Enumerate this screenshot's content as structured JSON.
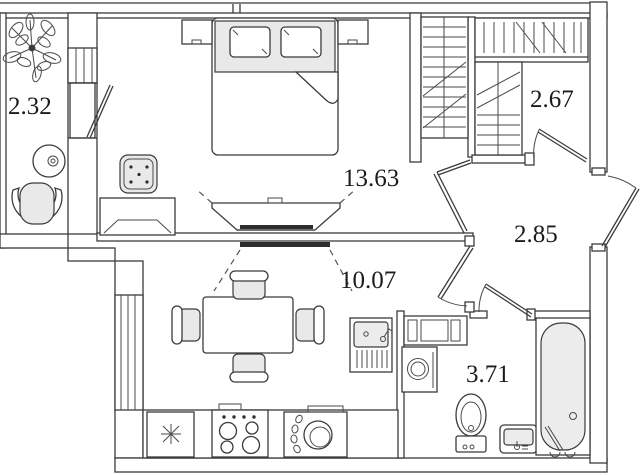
{
  "floor_plan": {
    "type": "apartment-floor-plan",
    "rooms": [
      {
        "name": "balcony",
        "area": "2.32"
      },
      {
        "name": "bedroom",
        "area": "13.63"
      },
      {
        "name": "closet",
        "area": "2.67"
      },
      {
        "name": "hallway",
        "area": "2.85"
      },
      {
        "name": "kitchen-living-room",
        "area": "10.07"
      },
      {
        "name": "bathroom",
        "area": "3.71"
      }
    ],
    "colors": {
      "wall_line": "#3b3b3b",
      "light_fill": "#e9e9e9",
      "background": "#ffffff"
    }
  }
}
